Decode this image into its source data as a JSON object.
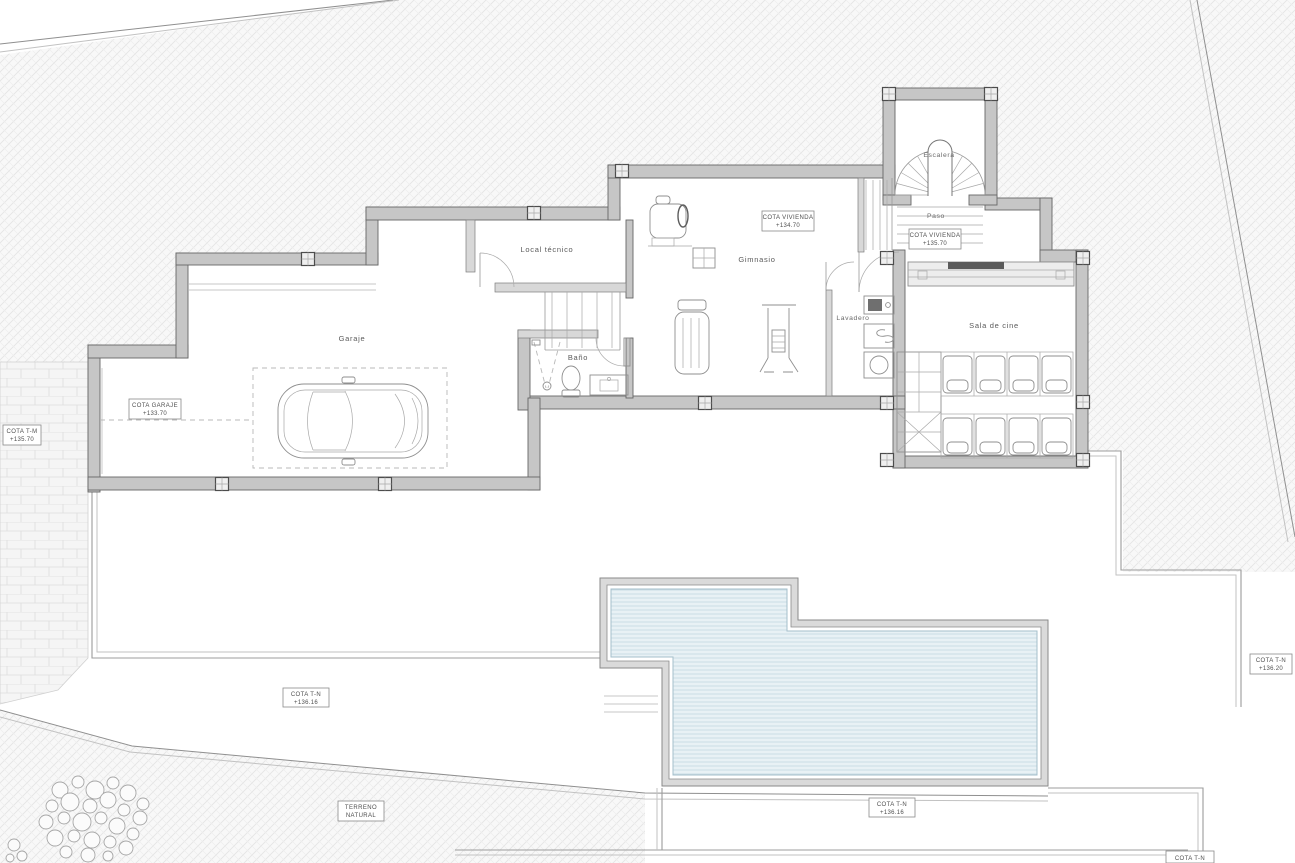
{
  "drawing": {
    "kind": "architectural floor plan",
    "level": "basement / garage level with pool terrace"
  },
  "rooms": {
    "garaje": "Garaje",
    "local_tecnico": "Local técnico",
    "bano": "Baño",
    "gimnasio": "Gimnasio",
    "lavadero": "Lavadero",
    "sala_de_cine": "Sala de cine",
    "paso": "Paso",
    "escalera": "Escalera"
  },
  "cotas": {
    "vivienda_gym": {
      "line1": "COTA VIVIENDA",
      "line2": "+134.70"
    },
    "vivienda_paso": {
      "line1": "COTA VIVIENDA",
      "line2": "+135.70"
    },
    "garaje": {
      "line1": "COTA GARAJE",
      "line2": "+133.70"
    },
    "tm_left": {
      "line1": "COTA T-M",
      "line2": "+135.70"
    },
    "tn_left": {
      "line1": "COTA T-N",
      "line2": "+136.16"
    },
    "tn_bottom": {
      "line1": "COTA T-N",
      "line2": "+136.16"
    },
    "tn_right": {
      "line1": "COTA T-N",
      "line2": "+136.20"
    },
    "tn_cut": {
      "line1": "COTA T-N",
      "line2": ""
    }
  },
  "site": {
    "terreno_line1": "TERRENO",
    "terreno_line2": "NATURAL"
  },
  "colors": {
    "wall_fill": "#c6c6c6",
    "wall_stroke": "#666666",
    "terrain_hatch": "#e2e2e2",
    "water_fill": "#e8f1f5",
    "water_line": "#c3d8e2",
    "line": "#9c9c9c",
    "text": "#5a5a5a"
  }
}
